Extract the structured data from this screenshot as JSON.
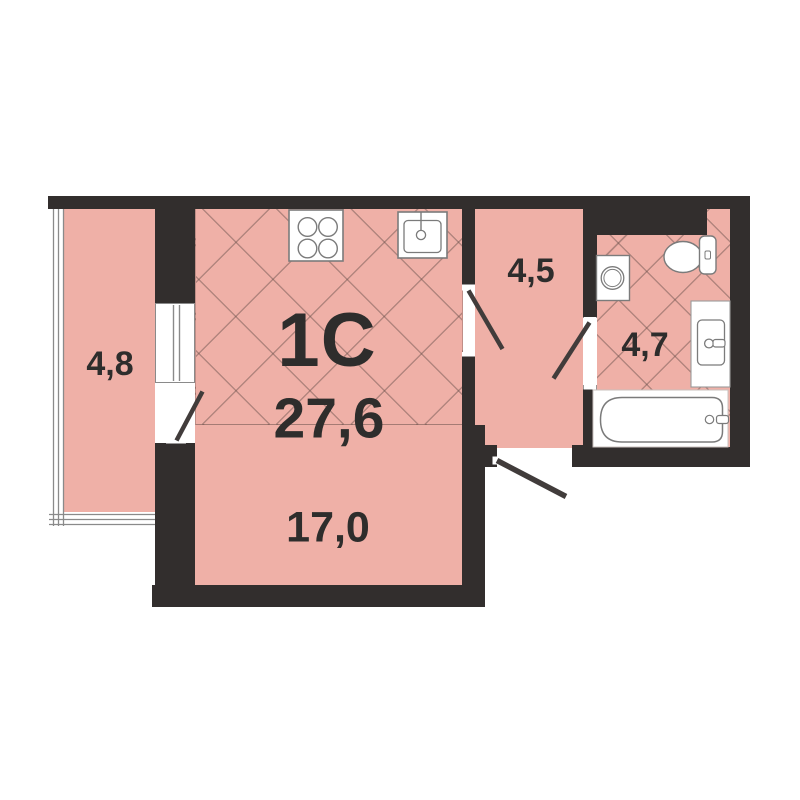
{
  "floorplan": {
    "title": "1C",
    "total_area": "27,6",
    "areas": {
      "living_room": "17,0",
      "balcony": "4,8",
      "hallway": "4,5",
      "bathroom": "4,7"
    },
    "colors": {
      "wall": "#322e2d",
      "floor": "#efb0a7",
      "background": "#ffffff",
      "text": "#2e2d2c",
      "fixture_stroke": "#7b7b7b",
      "glazing_stroke": "#8a8a8a"
    },
    "fixtures": [
      "stove-icon",
      "kitchen-sink-icon",
      "washing-machine-icon",
      "toilet-icon",
      "bathroom-sink-icon",
      "bathtub-icon",
      "balcony-window",
      "balcony-glazing",
      "balcony-door-swing",
      "kitchen-door-swing",
      "bathroom-door-swing",
      "entrance-door-swing"
    ]
  }
}
